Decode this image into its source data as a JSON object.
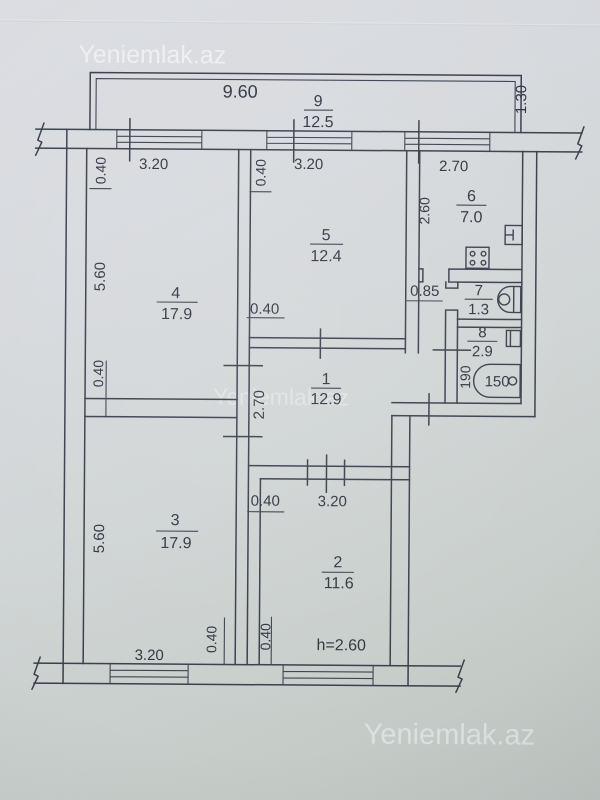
{
  "watermark": {
    "text": "Yeniemlak.az"
  },
  "rooms": {
    "r1": {
      "num": "1",
      "area": "12.9"
    },
    "r2": {
      "num": "2",
      "area": "11.6"
    },
    "r3": {
      "num": "3",
      "area": "17.9"
    },
    "r4": {
      "num": "4",
      "area": "17.9"
    },
    "r5": {
      "num": "5",
      "area": "12.4"
    },
    "r6": {
      "num": "6",
      "area": "7.0"
    },
    "r7": {
      "num": "7",
      "area": "1.3"
    },
    "r8": {
      "num": "8",
      "area": "2.9"
    },
    "r9": {
      "num": "9",
      "area": "12.5"
    }
  },
  "dims": {
    "balcony_length": "9.60",
    "balcony_depth": "1.30",
    "wall_thickness": "0.40",
    "room4_window": "3.20",
    "room5_window": "3.20",
    "kitchen_window": "2.70",
    "kitchen_depth": "2.60",
    "room4_height": "5.60",
    "room3_height": "5.60",
    "hall_width": "2.70",
    "entry_width": "0.85",
    "bath_length": "190",
    "bathtub_size": "150",
    "room2_width": "3.20",
    "room3_window": "3.20",
    "ceiling_height": "h=2.60"
  }
}
